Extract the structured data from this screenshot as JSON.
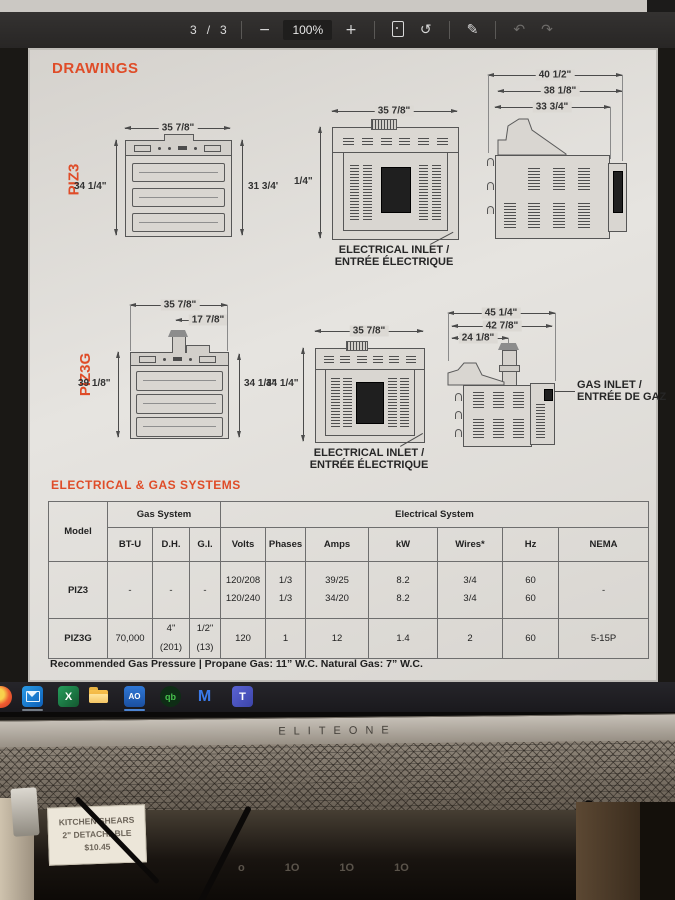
{
  "pdf_toolbar": {
    "page_current": "3",
    "page_divider": "/",
    "page_total": "3",
    "zoom_out": "−",
    "zoom_level": "100%",
    "zoom_in": "+",
    "rotate_glyph": "↺",
    "annotate_glyph": "✎",
    "undo_glyph": "↶",
    "redo_glyph": "↷"
  },
  "document": {
    "section_drawings": "DRAWINGS",
    "section_specs": "ELECTRICAL & GAS SYSTEMS",
    "piz3": {
      "label": "PIZ3",
      "front": {
        "dim_width": "35 7/8\"",
        "dim_left": "34 1/4\"",
        "dim_right": "31 3/4'"
      },
      "back": {
        "dim_width": "35 7/8\"",
        "dim_left": "1/4\"",
        "caption_line1": "ELECTRICAL INLET /",
        "caption_line2": "ENTRÉE ÉLECTRIQUE"
      },
      "side": {
        "dim1": "40 1/2\"",
        "dim2": "38 1/8\"",
        "dim3": "33 3/4\""
      }
    },
    "piz3g": {
      "label": "PIZ3G",
      "front": {
        "dim_width": "35 7/8\"",
        "dim_flue": "17 7/8\"",
        "dim_left": "39 1/8\"",
        "dim_right": "34 1/4\""
      },
      "back": {
        "dim_width": "35 7/8\"",
        "dim_left": "34 1/4\"",
        "caption_line1": "ELECTRICAL INLET /",
        "caption_line2": "ENTRÉE ÉLECTRIQUE"
      },
      "side": {
        "dim1": "45 1/4\"",
        "dim2": "42 7/8\"",
        "dim3": "24 1/8\"",
        "callout_line1": "GAS INLET /",
        "callout_line2": "ENTRÉE DE GAZ"
      }
    },
    "table": {
      "model_header": "Model",
      "gas_header": "Gas System",
      "electrical_header": "Electrical System",
      "columns": [
        "BT-U",
        "D.H.",
        "G.I.",
        "Volts",
        "Phases",
        "Amps",
        "kW",
        "Wires*",
        "Hz",
        "NEMA"
      ],
      "rows": [
        {
          "model": "PIZ3",
          "btu": "-",
          "dh": "-",
          "gi": "-",
          "volts": [
            "120/208",
            "120/240"
          ],
          "phases": [
            "1/3",
            "1/3"
          ],
          "amps": [
            "39/25",
            "34/20"
          ],
          "kw": [
            "8.2",
            "8.2"
          ],
          "wires": [
            "3/4",
            "3/4"
          ],
          "hz": [
            "60",
            "60"
          ],
          "nema": "-"
        },
        {
          "model": "PIZ3G",
          "btu": "70,000",
          "dh": [
            "4\"",
            "(201)"
          ],
          "gi": [
            "1/2\"",
            "(13)"
          ],
          "volts": "120",
          "phases": "1",
          "amps": "12",
          "kw": "1.4",
          "wires": "2",
          "hz": "60",
          "nema": "5-15P"
        }
      ]
    },
    "footnote": "Recommended Gas Pressure | Propane Gas: 11” W.C.  Natural Gas: 7” W.C."
  },
  "taskbar": {
    "icons": [
      {
        "name": "browser"
      },
      {
        "name": "outlook"
      },
      {
        "name": "excel",
        "glyph": "X"
      },
      {
        "name": "file-explorer"
      },
      {
        "name": "ao",
        "glyph": "AO"
      },
      {
        "name": "quickbooks",
        "glyph": "qb"
      },
      {
        "name": "m-app",
        "glyph": "M"
      },
      {
        "name": "teams",
        "glyph": "T"
      }
    ]
  },
  "monitor": {
    "brand": "ELITEONE"
  },
  "desk": {
    "price_tag": {
      "line1": "KITCHEN SHEARS",
      "line2": "2\" DETACHABLE",
      "line3": "$10.45"
    },
    "markings": [
      "o",
      "1O",
      "1O",
      "1O"
    ]
  }
}
